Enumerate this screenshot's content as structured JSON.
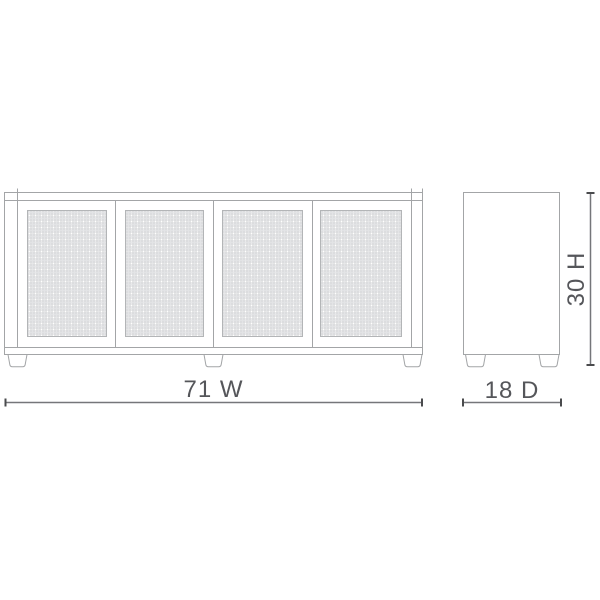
{
  "diagram": {
    "type": "furniture-dimension-drawing",
    "views": {
      "front": {
        "name": "front-elevation",
        "door_count": 4,
        "leg_count": 3
      },
      "side": {
        "name": "side-elevation",
        "leg_count": 2
      }
    },
    "dimensions": {
      "width": {
        "label": "71 W",
        "value": 71,
        "axis": "W"
      },
      "depth": {
        "label": "18 D",
        "value": 18,
        "axis": "D"
      },
      "height": {
        "label": "30 H",
        "value": 30,
        "axis": "H"
      }
    },
    "colors": {
      "background": "#ffffff",
      "outline": "#a3a5a7",
      "mesh_line": "#cbccce",
      "mesh_line_light": "#e2e3e5",
      "dimension_line": "#75767a",
      "dimension_tick": "#4a4b4d",
      "label_text": "#55565a"
    }
  }
}
